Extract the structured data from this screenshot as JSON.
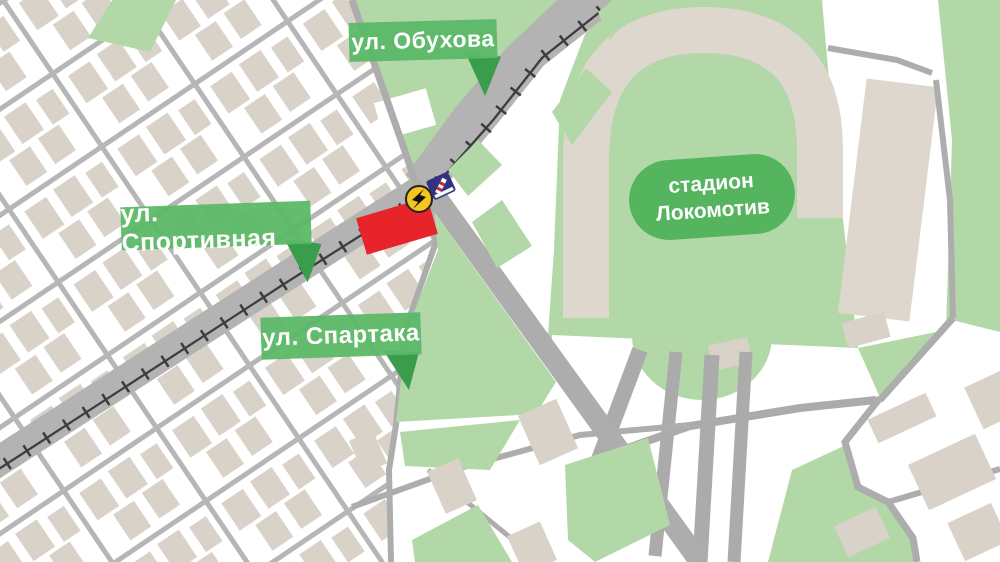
{
  "map": {
    "labels": {
      "obukhova": "ул. Обухова",
      "sportivnaya": "ул. Спортивная",
      "spartaka": "ул. Спартака",
      "stadium_line1": "стадион",
      "stadium_line2": "Локомотив"
    },
    "markers": {
      "closure": "road-closure-marker",
      "incident": "lightning-incident-icon",
      "crossing": "railway-crossing-icon"
    },
    "colors": {
      "background": "#ffffff",
      "park_green": "#b2d8a8",
      "label_green": "#5cb867",
      "label_pointer_green": "#3a9d4b",
      "stadium_label_green": "#55b45e",
      "building_beige": "#d9d2c9",
      "stands_beige": "#ded7cd",
      "road_gray": "#b3b3b3",
      "rail_dark": "#3d3d3d",
      "closure_red": "#e8242b",
      "incident_yellow": "#f6c51f",
      "crossing_blue": "#32327e"
    }
  }
}
